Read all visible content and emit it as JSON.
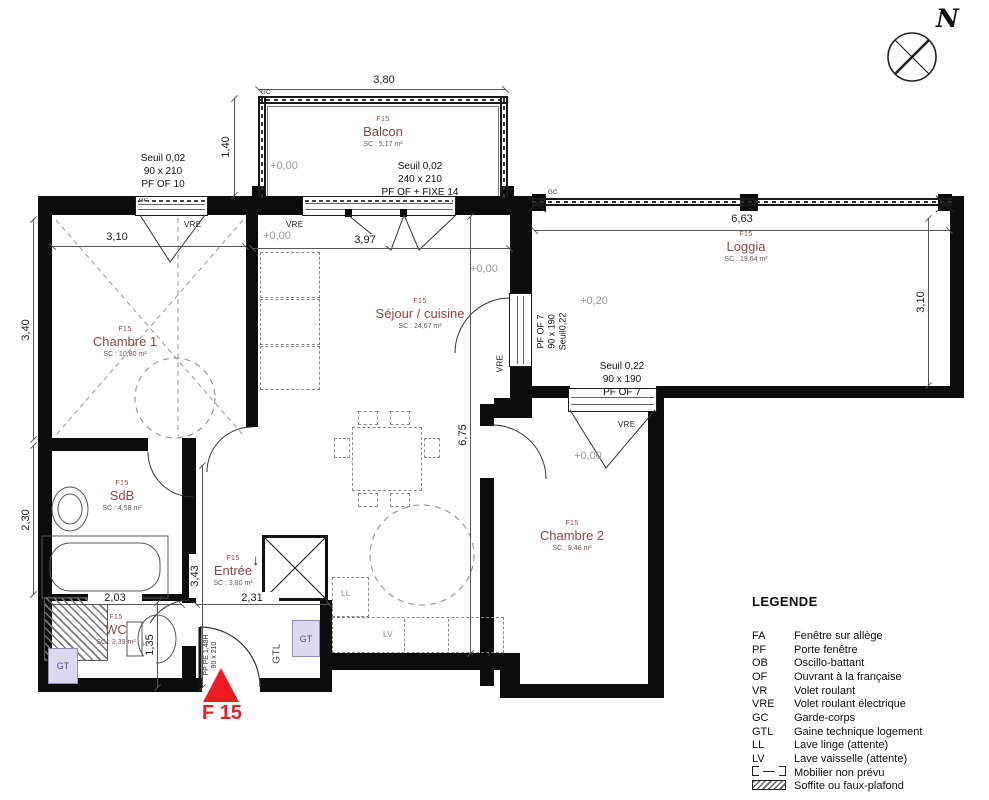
{
  "meta": {
    "north_label": "N"
  },
  "unit": {
    "marker": "F 15"
  },
  "rooms": [
    {
      "unit": "F15",
      "name": "Balcon",
      "area": "SC : 5,17 m²"
    },
    {
      "unit": "F15",
      "name": "Chambre 1",
      "area": "SC : 10,80 m²"
    },
    {
      "unit": "F15",
      "name": "Séjour / cuisine",
      "area": "SC : 24,67 m²"
    },
    {
      "unit": "F15",
      "name": "Loggia",
      "area": "SC : 19,64 m²"
    },
    {
      "unit": "F15",
      "name": "SdB",
      "area": "SC : 4,58 m²"
    },
    {
      "unit": "F15",
      "name": "Entrée",
      "area": "SC : 3,80 m²"
    },
    {
      "unit": "F15",
      "name": "WC",
      "area": "SC : 2,39 m²"
    },
    {
      "unit": "F15",
      "name": "Chambre 2",
      "area": "SC : 9,48 m²"
    }
  ],
  "dims": {
    "balcon_w": "3,80",
    "balcon_d": "1,40",
    "ch1_w": "3,10",
    "ch1_h": "3,40",
    "sdb_h": "2,30",
    "sejour_w": "3,97",
    "sejour_h": "6,75",
    "loggia_w": "6,63",
    "loggia_h": "3,10",
    "entree_h": "3,43",
    "sdb_w": "2,03",
    "entree_w": "2,31",
    "wc_h": "1,35"
  },
  "levels": {
    "balcon": "+0,00",
    "sejour_a": "+0,00",
    "sejour_b": "+0,00",
    "loggia": "+0,20",
    "chambre2": "+0,00"
  },
  "openings": {
    "win_ch1": [
      "Seuil 0,02",
      "90 x 210",
      "PF OF 10"
    ],
    "door_balcon": [
      "Seuil 0,02",
      "240 x 210",
      "PF OF + FIXE 14"
    ],
    "door_loggia_v": [
      "PF OF 7",
      "90 x 190",
      "Seuil0,22"
    ],
    "door_loggia_ch2": [
      "Seuil 0,22",
      "90 x 190",
      "PF OF 7"
    ],
    "entry_door": [
      "PP PE 1,48H",
      "90 x 210"
    ]
  },
  "tags": {
    "gc": "GC",
    "vre": "VRE",
    "gt": "GT",
    "gtl": "GTL",
    "ll": "LL",
    "lv": "LV"
  },
  "icons": {
    "down_arrow": "↓"
  },
  "legend": {
    "title": "LEGENDE",
    "items": [
      {
        "abbr": "FA",
        "label": "Fenêtre sur allège"
      },
      {
        "abbr": "PF",
        "label": "Porte fenêtre"
      },
      {
        "abbr": "OB",
        "label": "Oscillo-battant"
      },
      {
        "abbr": "OF",
        "label": "Ouvrant à la française"
      },
      {
        "abbr": "VR",
        "label": "Volet roulant"
      },
      {
        "abbr": "VRE",
        "label": "Volet roulant électrique"
      },
      {
        "abbr": "GC",
        "label": "Garde-corps"
      },
      {
        "abbr": "GTL",
        "label": "Gaine technique logement"
      },
      {
        "abbr": "LL",
        "label": "Lave linge (attente)"
      },
      {
        "abbr": "LV",
        "label": "Lave vaisselle (attente)"
      },
      {
        "abbr": "",
        "label": "Mobilier non prévu"
      },
      {
        "abbr": "",
        "label": "Soffite ou faux-plafond"
      }
    ]
  },
  "colors": {
    "room_name": "#8e4444",
    "marker_red": "#ed1c24",
    "gt_text": "#4d4da0",
    "gt_bg": "#ddd8f0",
    "dim_text": "#1a1a1a",
    "level_text": "#979797"
  }
}
